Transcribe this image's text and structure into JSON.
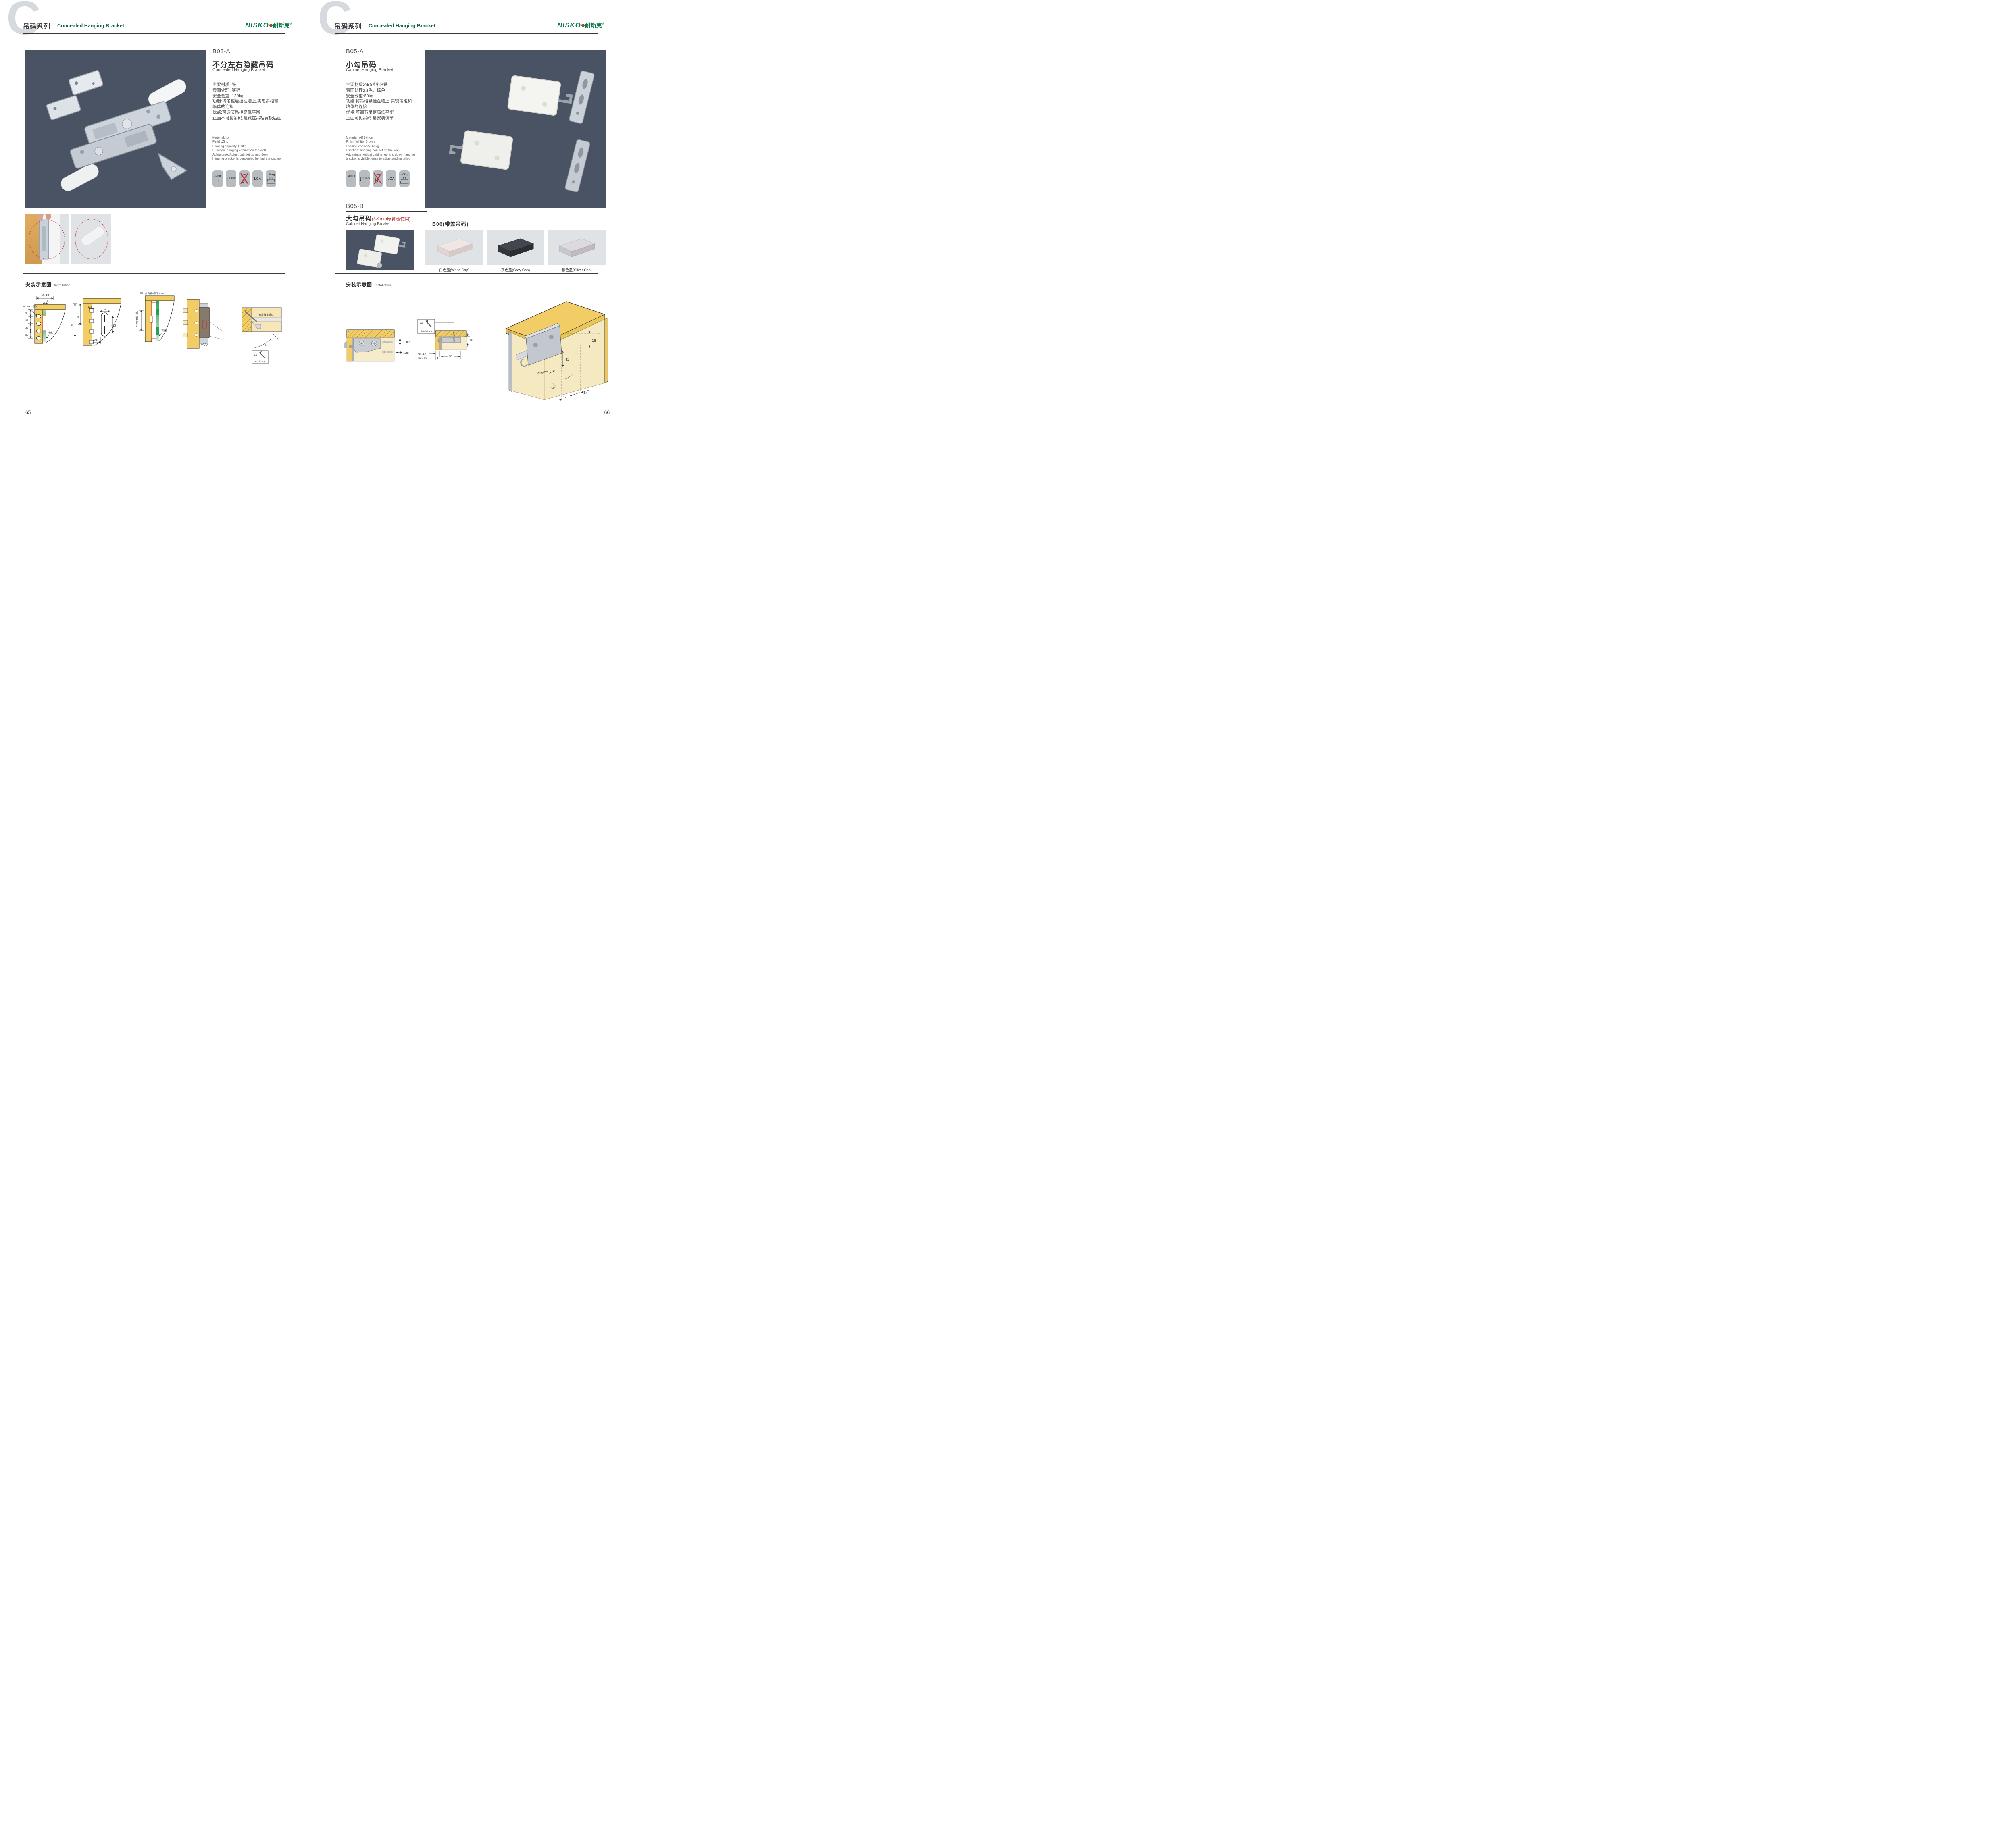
{
  "brand": {
    "logo_en": "NISKO",
    "logo_zh": "耐斯克",
    "logo_reg": "®"
  },
  "colors": {
    "brand_green": "#0b7a4b",
    "accent_red": "#b5222a",
    "photo_bg": "#4a5363",
    "wood": "#f2cd66"
  },
  "left_page": {
    "watermark": "C",
    "header": {
      "series_zh": "吊码系列",
      "series_en": "Concealed Hanging Bracket"
    },
    "product": {
      "code": "B03-A",
      "title_zh": "不分左右隐藏吊码",
      "title_en": "Concealed Hanging Bracket",
      "specs_zh": [
        "主要材质: 铁",
        "表面处理: 镀锌",
        "安全载重: 120kg",
        "功能:将吊柜悬挂在墙上,实现吊柜和",
        "墙体的连接",
        "优点:可调节吊柜高低平衡",
        "正面不可见吊码,隐藏在吊柜背板后面"
      ],
      "specs_en": [
        "Material:Iron",
        "Finish:Zinc",
        "Loading capacity:120kg",
        "Function: hanging cabinet on the wall",
        "Advantage: Adjust cabinet up and down",
        "hanging bracket is concealed behind the cabinet"
      ],
      "icons": {
        "width": "10mm",
        "height": "10mm",
        "cert": "LGA",
        "load": "120Kg"
      }
    },
    "installation": {
      "label_zh": "安装示意图",
      "label_en": "Installation",
      "d1": {
        "dim_top": "16-18",
        "dim_top2": "5",
        "dim_a": "35",
        "dim_b": "32",
        "dim_c": "32",
        "dim_d": "32",
        "callout": "Φ10-4个均布",
        "back_panel": "背板"
      },
      "d2": {
        "dim_60": "60",
        "dim_35": "35",
        "dim_125": "12.5",
        "dim_12": "12",
        "dim_425": "42.5",
        "dim_205": "20.5"
      },
      "d3": {
        "top_note": "前后最大调节10mm",
        "side_note": "上下调节10mm",
        "back_panel": "背板"
      },
      "d4": {
        "detail_note": "安装自攻螺丝",
        "angle": "45°",
        "screw_count": "1x",
        "screw_size": "Φ3.5mm"
      }
    },
    "page_number": "65"
  },
  "right_page": {
    "watermark": "C",
    "header": {
      "series_zh": "吊码系列",
      "series_en": "Concealed Hanging Bracket"
    },
    "product_a": {
      "code": "B05-A",
      "title_zh": "小勾吊码",
      "title_en": "Cabinet Hanging Bracket",
      "specs_zh": [
        "主要材质:ABS塑料+铁",
        "表面处理:白色、棕色",
        "安全载重:60kg",
        "功能:将吊柜悬挂在墙上,实现吊柜和",
        "墙体的连接",
        "优点:可调节吊柜高低平衡",
        "正面可见吊码,易安装调节"
      ],
      "specs_en": [
        "Material: ABS+Iron",
        "Finish:White, Brown",
        "Loading capacity: 60kg",
        "Function: hanging cabinet on the wall",
        "Advantage: Adjust cabinet up and down hanging",
        "bracket is visible, easy to adjust and installed"
      ],
      "icons": {
        "width": "15mm",
        "height": "10mm",
        "cert": "LGA",
        "load": "60Kg"
      }
    },
    "product_b": {
      "code": "B05-B",
      "title_zh": "大勾吊码",
      "title_note": "(3-9mm厚背板使用)",
      "title_en": "Cabinet Hanging Brcaket"
    },
    "b06": {
      "label": "B06(带盖吊码)",
      "caps": [
        {
          "label": "白色盖(White Cap)"
        },
        {
          "label": "灰色盖(Gray Cap)"
        },
        {
          "label": "银色盖(Silver Cap)"
        }
      ]
    },
    "installation": {
      "label_zh": "安装示意图",
      "label_en": "Installation",
      "d1": {
        "dim_v": "10mm",
        "dim_h": "15mm"
      },
      "d2": {
        "screw_count": "2x",
        "screw_size": "Φ4×30mm",
        "dim_18": "18",
        "dim_min": "MIN.10",
        "dim_max": "MAX.23",
        "dim_58": "58"
      },
      "d3": {
        "dim_16a": "16",
        "dim_42": "42",
        "dim_r": "RMAX4",
        "dim_16b": "16",
        "dim_17": "17",
        "dim_32": "32"
      }
    },
    "page_number": "66"
  }
}
